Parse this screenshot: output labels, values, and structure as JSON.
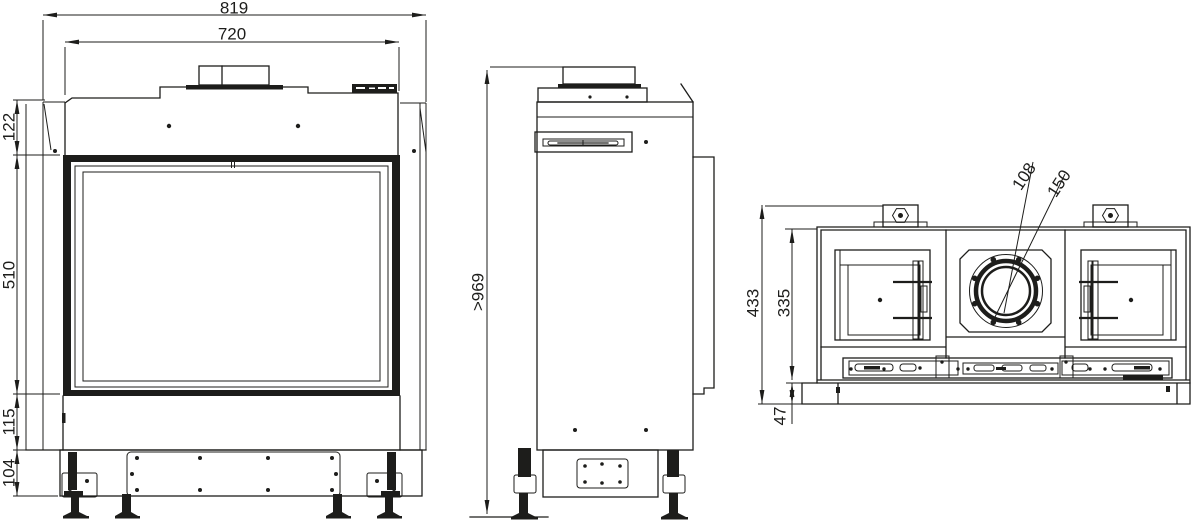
{
  "page": {
    "background": "#ffffff",
    "line_color": "#1d1d1b"
  },
  "views": {
    "front": {
      "dims": {
        "overall_width": "819",
        "body_width": "720",
        "top_section_height": "122",
        "glass_height": "510",
        "lower_section_height": "115",
        "base_height": "104"
      }
    },
    "side": {
      "dims": {
        "min_height": ">969"
      }
    },
    "rear": {
      "dims": {
        "overall_depth": "433",
        "body_depth": "335",
        "base_lip_depth": "47",
        "flue_inner_diameter": "108",
        "flue_collar_diameter": "150"
      }
    }
  }
}
